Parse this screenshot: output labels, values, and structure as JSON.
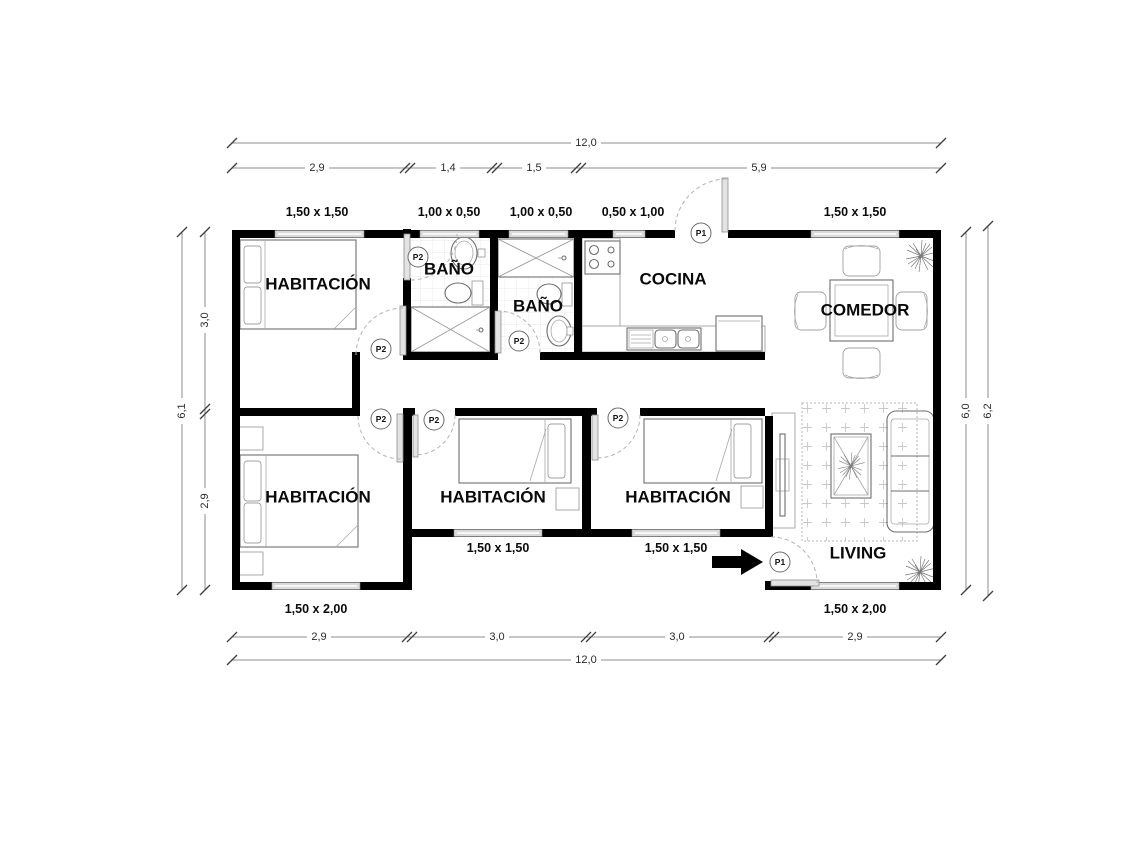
{
  "rooms": {
    "bedroom1": "HABITACIÓN",
    "bedroom2": "HABITACIÓN",
    "bedroom3": "HABITACIÓN",
    "bedroom4": "HABITACIÓN",
    "bath1": "BAÑO",
    "bath2": "BAÑO",
    "kitchen": "COCINA",
    "dining": "COMEDOR",
    "living": "LIVING"
  },
  "doors": {
    "main": "P1",
    "interior": "P2"
  },
  "windows": {
    "top": [
      "1,50 x 1,50",
      "1,00 x 0,50",
      "1,00 x 0,50",
      "0,50 x 1,00",
      "1,50 x 1,50"
    ],
    "bottom": [
      "1,50 x 2,00",
      "1,50 x 1,50",
      "1,50 x 1,50",
      "1,50 x 2,00"
    ]
  },
  "dimensions": {
    "top_total": "12,0",
    "top_segments": [
      "2,9",
      "1,4",
      "1,5",
      "5,9"
    ],
    "bottom_segments": [
      "2,9",
      "3,0",
      "3,0",
      "2,9"
    ],
    "bottom_total": "12,0",
    "left_segments": [
      "3,0",
      "2,9"
    ],
    "left_total": "6,1",
    "right_inner": "6,0",
    "right_outer": "6,2"
  },
  "colors": {
    "wall": "#000000",
    "dimension_line": "#8c8c8c",
    "label_text": "#0a0a0a"
  }
}
